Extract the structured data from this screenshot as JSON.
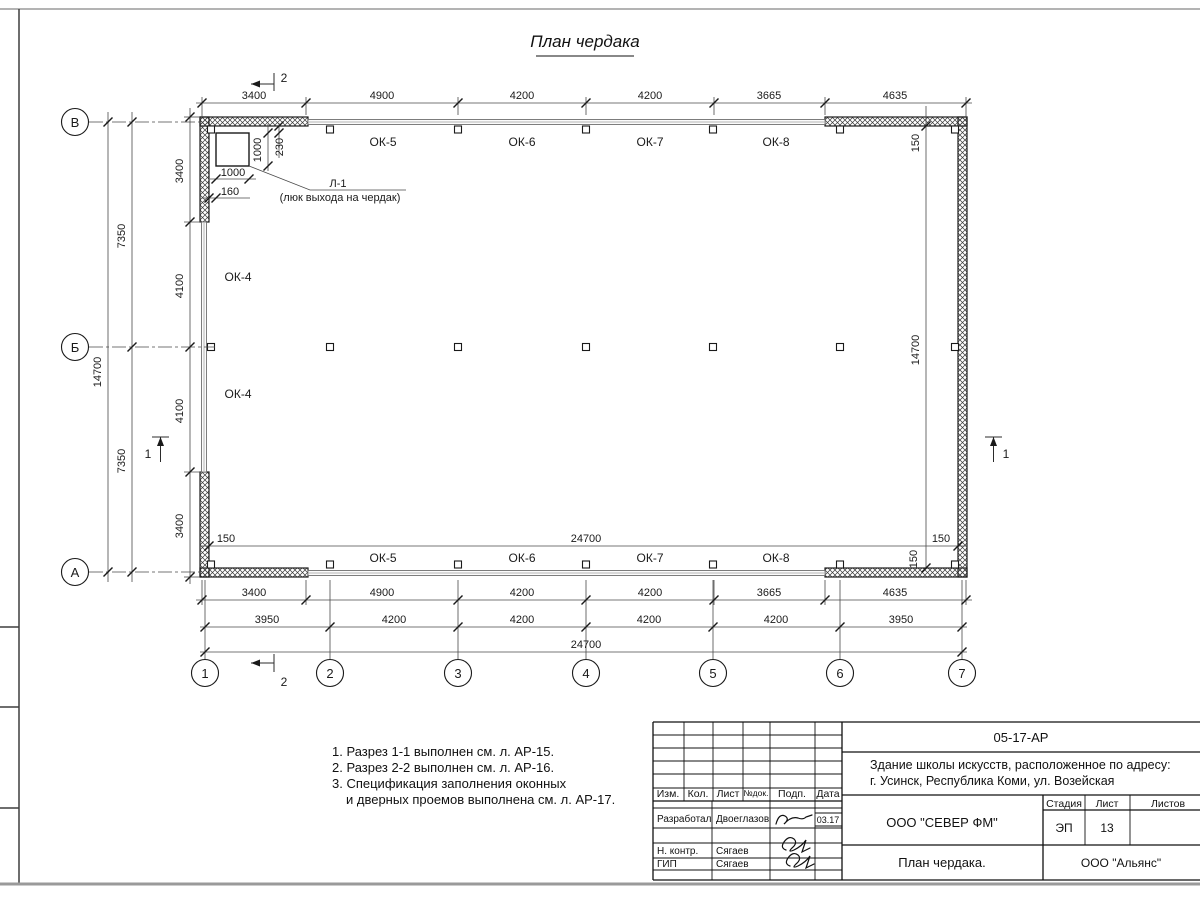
{
  "sheet": {
    "title": "План чердака",
    "axis_rows": [
      "В",
      "Б",
      "А"
    ],
    "axis_cols": [
      "1",
      "2",
      "3",
      "4",
      "5",
      "6",
      "7"
    ],
    "section1": "1",
    "section2": "2"
  },
  "plan": {
    "windows_top": [
      "ОК-5",
      "ОК-6",
      "ОК-7",
      "ОК-8"
    ],
    "windows_bottom": [
      "ОК-5",
      "ОК-6",
      "ОК-7",
      "ОК-8"
    ],
    "windows_left": [
      "ОК-4",
      "ОК-4"
    ],
    "hatch": {
      "code": "Л-1",
      "desc": "(люк выхода на чердак)",
      "dim_v": "1000",
      "dim_offset": "230",
      "dim_h": "1000",
      "dim_edge": "160"
    }
  },
  "dims": {
    "top": [
      "3400",
      "4900",
      "4200",
      "4200",
      "3665",
      "4635"
    ],
    "bottom_outer": [
      "3400",
      "4900",
      "4200",
      "4200",
      "3665",
      "4635"
    ],
    "bottom_axes": [
      "3950",
      "4200",
      "4200",
      "4200",
      "4200",
      "3950"
    ],
    "bottom_total": "24700",
    "interior_width": "24700",
    "interior_height": "14700",
    "left_total": "14700",
    "left_half_1": "7350",
    "left_half_2": "7350",
    "left_inner": [
      "3400",
      "4100",
      "4100",
      "3400"
    ],
    "wall_150": "150"
  },
  "notes": [
    "1. Разрез 1-1 выполнен см. л. АР-15.",
    "2. Разрез 2-2 выполнен см. л. АР-16.",
    "3. Спецификация заполнения оконных",
    "и дверных проемов выполнена см. л. АР-17."
  ],
  "titleblock": {
    "doc_number": "05-17-АР",
    "project_line1": "Здание школы искусств, расположенное по адресу:",
    "project_line2": "г. Усинск, Республика Коми, ул. Возейская",
    "org": "ООО \"СЕВЕР ФМ\"",
    "sheet_name": "План чердака.",
    "client": "ООО \"Альянс\"",
    "stage_label": "Стадия",
    "sheet_label": "Лист",
    "sheets_label": "Листов",
    "stage": "ЭП",
    "sheet_no": "13",
    "cols": [
      "Изм.",
      "Кол.",
      "Лист",
      "№док.",
      "Подп.",
      "Дата"
    ],
    "rows": [
      {
        "role": "Разработал",
        "name": "Двоеглазов",
        "date": "03.17"
      },
      {
        "role": "Н. контр.",
        "name": "Сягаев"
      },
      {
        "role": "ГИП",
        "name": "Сягаев"
      }
    ]
  }
}
